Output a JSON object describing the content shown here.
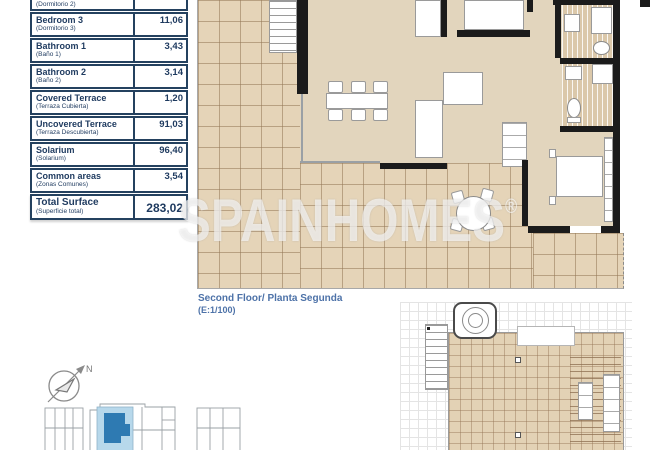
{
  "table": {
    "rows": [
      {
        "name": "",
        "subtitle": "(Dormitorio 2)",
        "value": ""
      },
      {
        "name": "Bedroom 3",
        "subtitle": "(Dormitorio 3)",
        "value": "11,06"
      },
      {
        "name": "Bathroom 1",
        "subtitle": "(Baño 1)",
        "value": "3,43"
      },
      {
        "name": "Bathroom 2",
        "subtitle": "(Baño 2)",
        "value": "3,14"
      },
      {
        "name": "Covered Terrace",
        "subtitle": "(Terraza Cubierta)",
        "value": "1,20"
      },
      {
        "name": "Uncovered Terrace",
        "subtitle": "(Terraza Descubierta)",
        "value": "91,03"
      },
      {
        "name": "Solarium",
        "subtitle": "(Solarium)",
        "value": "96,40"
      },
      {
        "name": "Common areas",
        "subtitle": "(Zonas Comunes)",
        "value": "3,54"
      }
    ],
    "total": {
      "name": "Total Surface",
      "subtitle": "(Superficie total)",
      "value": "283,02"
    }
  },
  "plan": {
    "title": "Second Floor/ Planta Segunda",
    "scale": "(E:1/100)"
  },
  "watermark": {
    "text": "SPAINHOMES",
    "registered": "®"
  },
  "compass": {
    "label": "N"
  },
  "colors": {
    "table_navy": "#1e3a5f",
    "label_blue": "#4d72a8",
    "tile_beige": "#e5d4b8",
    "tile_line": "#b19678",
    "wall_black": "#1b1b1b",
    "site_highlight_light": "#b7d8eb",
    "site_highlight_dark": "#2e7ab2",
    "watermark_white": "rgba(255,255,255,0.62)"
  }
}
